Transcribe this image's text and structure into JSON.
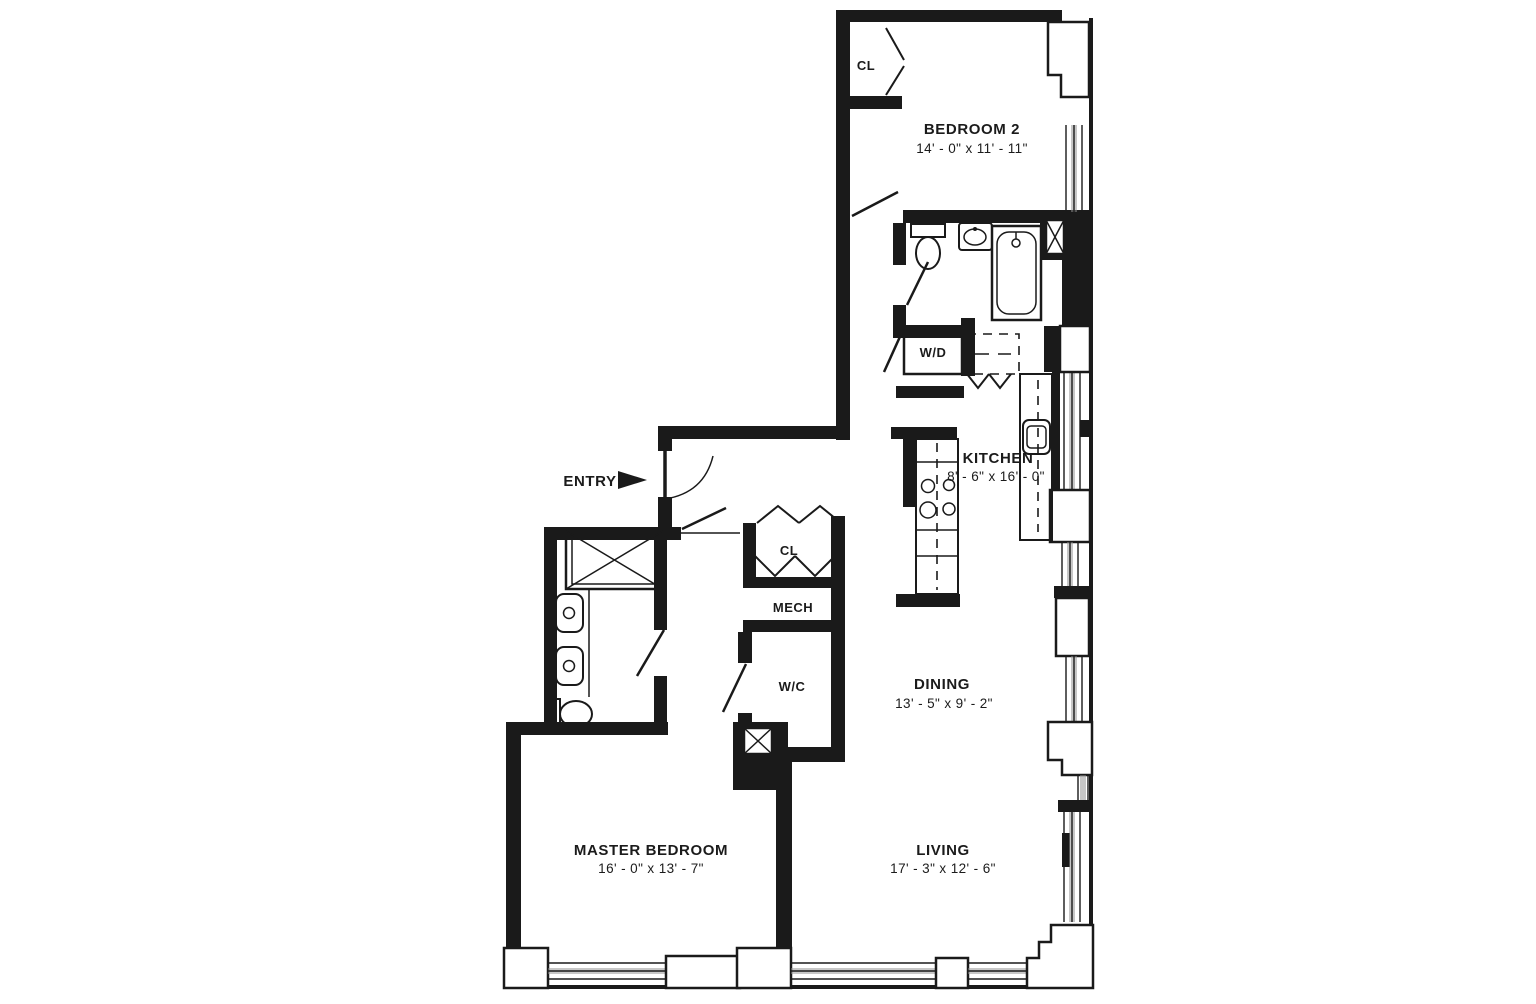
{
  "fp": {
    "colors": {
      "ink": "#1a1a1a",
      "window_gray": "#8f8f8f",
      "paper": "#ffffff"
    },
    "rooms": [
      {
        "id": "bedroom-2",
        "label": "BEDROOM 2",
        "dimensions": "14' - 0\" x 11' - 11\""
      },
      {
        "id": "kitchen",
        "label": "KITCHEN",
        "dimensions": "8' - 6\" x 16' - 0\""
      },
      {
        "id": "dining",
        "label": "DINING",
        "dimensions": "13' - 5\" x 9' - 2\""
      },
      {
        "id": "living",
        "label": "LIVING",
        "dimensions": "17' - 3\" x 12' - 6\""
      },
      {
        "id": "master-bedroom",
        "label": "MASTER BEDROOM",
        "dimensions": "16' - 0\" x 13' - 7\""
      }
    ],
    "labels": {
      "entry": "ENTRY",
      "closet_bedroom2": "CL",
      "closet_hall": "CL",
      "mech": "MECH",
      "wc": "W/C",
      "washer_dryer": "W/D"
    }
  }
}
